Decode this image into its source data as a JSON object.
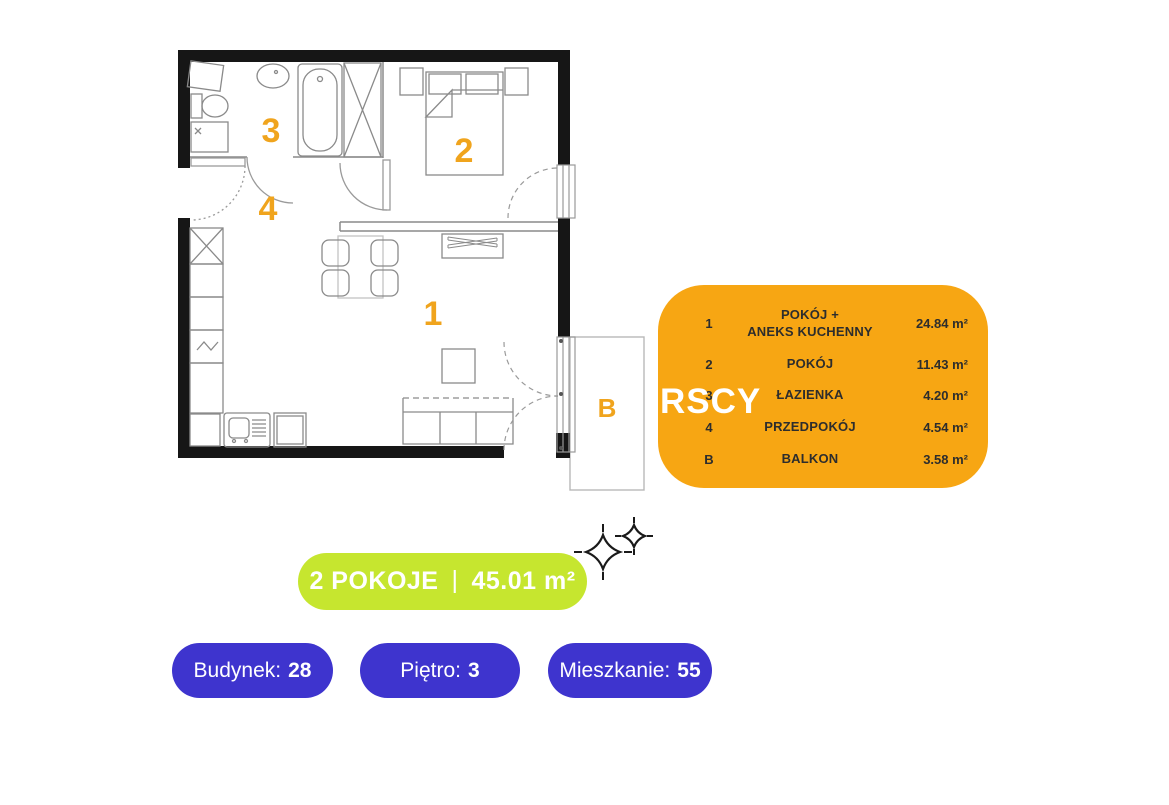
{
  "floor_plan": {
    "room_labels": {
      "living": "1",
      "bedroom": "2",
      "bathroom": "3",
      "hall": "4",
      "balcony": "B"
    }
  },
  "legend": {
    "rows": [
      {
        "num": "1",
        "name": "POKÓJ +\nANEKS KUCHENNY",
        "area": "24.84 m²"
      },
      {
        "num": "2",
        "name": "POKÓJ",
        "area": "11.43 m²"
      },
      {
        "num": "3",
        "name": "ŁAZIENKA",
        "area": "4.20 m²"
      },
      {
        "num": "4",
        "name": "PRZEDPOKÓJ",
        "area": "4.54 m²"
      },
      {
        "num": "B",
        "name": "BALKON",
        "area": "3.58 m²"
      }
    ]
  },
  "watermark": {
    "text": "RSCY"
  },
  "summary": {
    "rooms": "2 POKOJE",
    "separator": "|",
    "area": "45.01 m²"
  },
  "info_badges": [
    {
      "label": "Budynek:",
      "value": "28"
    },
    {
      "label": "Piętro:",
      "value": "3"
    },
    {
      "label": "Mieszkanie:",
      "value": "55"
    }
  ],
  "colors": {
    "accent_orange": "#F7A613",
    "accent_lime": "#C6E62F",
    "accent_purple": "#3E34CE",
    "label_orange": "#F0A41D",
    "wall_black": "#161616",
    "legend_text": "#2D2D2D"
  }
}
